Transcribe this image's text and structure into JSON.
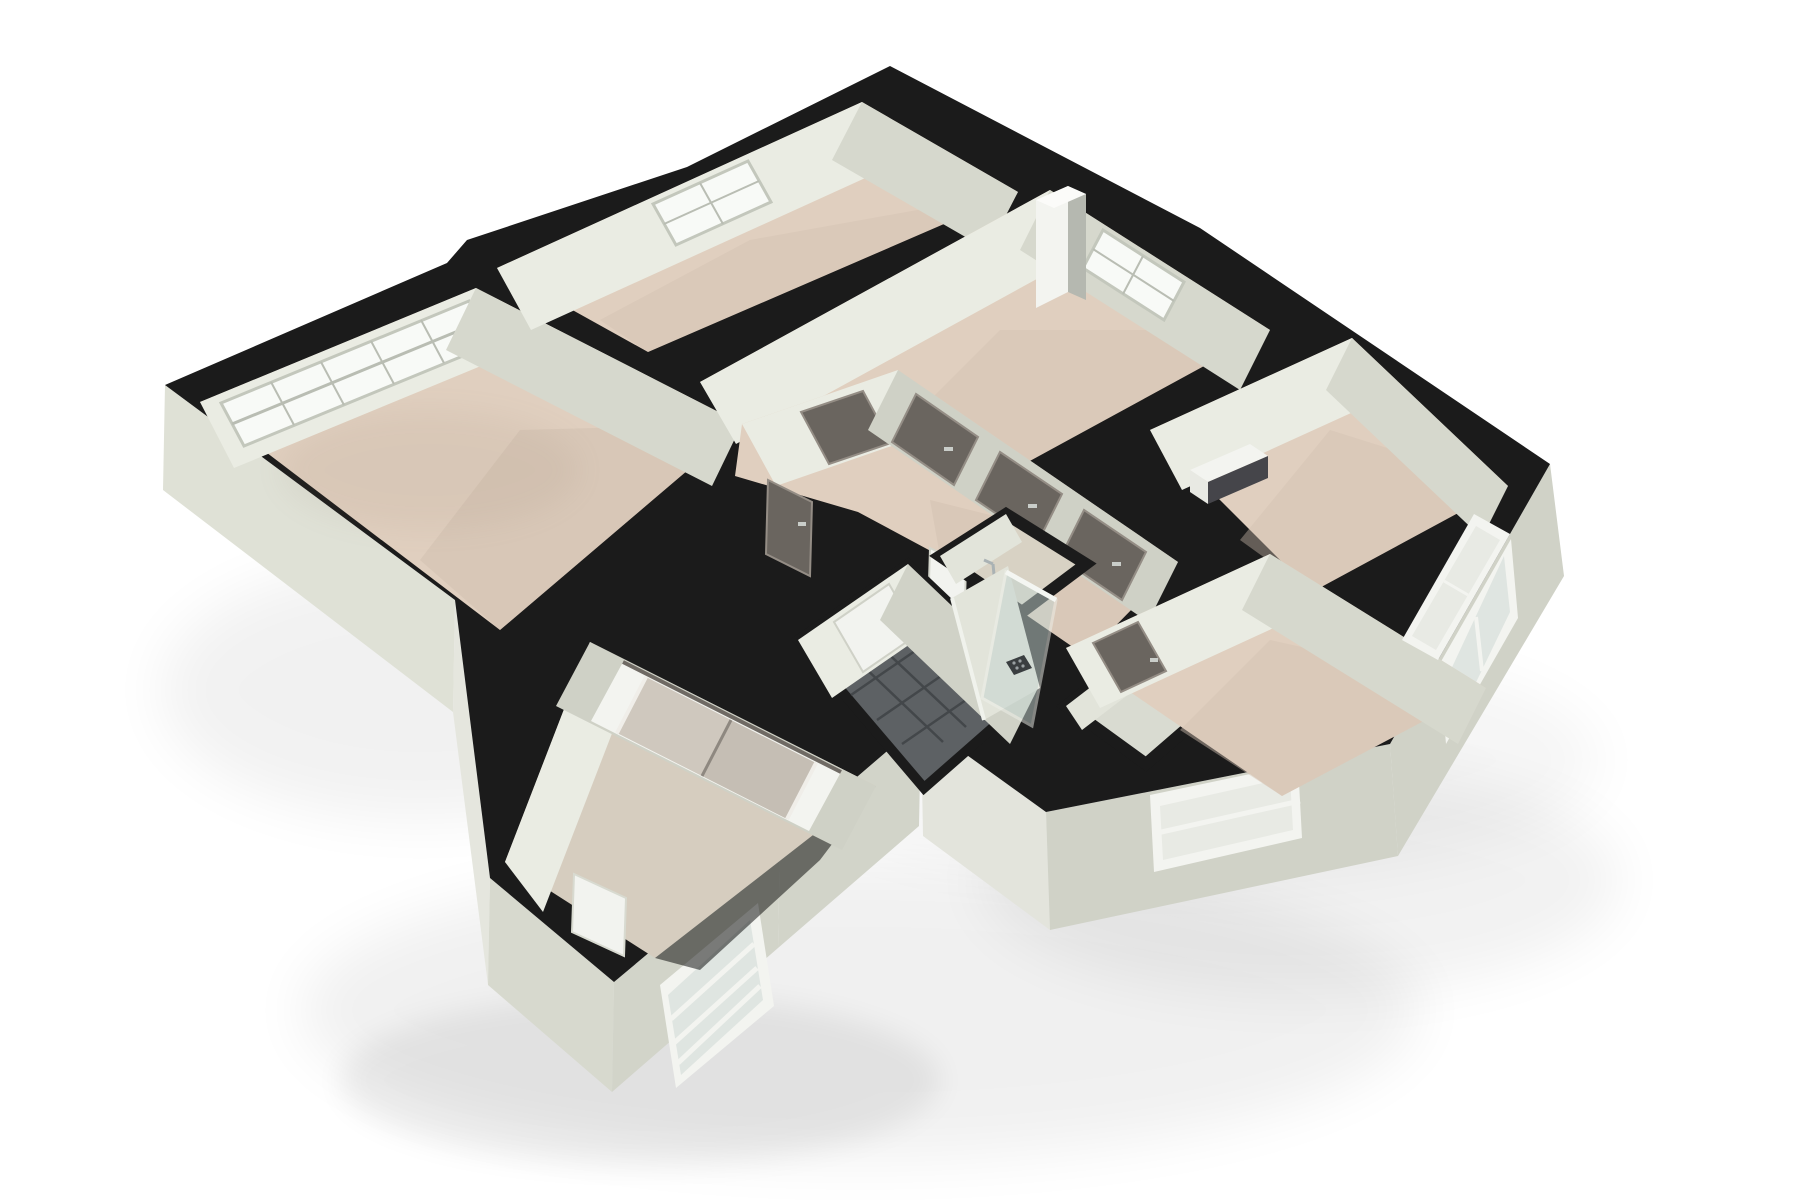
{
  "scene": {
    "type": "3d-floorplan-cutaway-render",
    "view": "isometric top-down dollhouse view",
    "background": "#ffffff",
    "visible_text": "",
    "rooms": [
      "living-room",
      "bedroom-1",
      "bedroom-2",
      "kitchen-room",
      "hallway",
      "lower-bedroom",
      "bathroom",
      "toilet-room",
      "storage-room",
      "right-bedroom"
    ],
    "features": [
      "living-room-window-band",
      "bedroom-1-window",
      "bedroom-2-window",
      "right-facade-window",
      "lower-facade-window",
      "bottom-facade-window",
      "sliding-double-door",
      "dark-interior-doors",
      "white-doors",
      "shower-glass-panel",
      "shower-drain",
      "shower-fixture",
      "bathroom-tile-floor",
      "service-shaft-column",
      "radiator-box",
      "drop-shadow"
    ],
    "counts": {
      "windows": 6,
      "dark_doors": 6,
      "white_doors": 3,
      "sliding_panels": 2
    }
  },
  "colors": {
    "background": "#ffffff",
    "cap": "#1b1b1b",
    "wall_lit": "#eaece3",
    "wall_light": "#e2e4da",
    "wall_mid": "#d6d8cd",
    "wall_shade": "#cfd1c6",
    "skirt_left": "#dfe1d6",
    "skirt_left_lit": "#e5e6de",
    "skirt_bottom": "#d7d9ce",
    "skirt_dark": "#d2d4c9",
    "skirt_right": "#d0d2c7",
    "skirt_bath": "#e3e4dc",
    "floor_tan": "#e0cfbf",
    "floor_tan_dark": "#d2c1b1",
    "floor_gray_tan": "#d6cdbf",
    "floor_gray": "#d9dbd1",
    "floor_warm_gray": "#d8d2c4",
    "tile": "#5d6164",
    "tile_grout": "#43474a",
    "tile_sheen": "#74787b",
    "glass_white": "#f8faf7",
    "glass_cool": "#dfe5e1",
    "glass_pane": "#e8eae4",
    "window_frame": "#c3c7bc",
    "white_trim": "#f3f4f0",
    "door_dark": "#6a655f",
    "door_frame": "#948d85",
    "door_white": "#f2f3ef",
    "panel_beige": "#cfc8be",
    "panel_beige2": "#c5beb4",
    "track_dark": "#6f6a64",
    "chrome": "#b2babc",
    "handle": "#c9cdc9",
    "shaft_side": "#b5b8b0",
    "box_dark": "#45454a",
    "shadow": "#000000"
  }
}
